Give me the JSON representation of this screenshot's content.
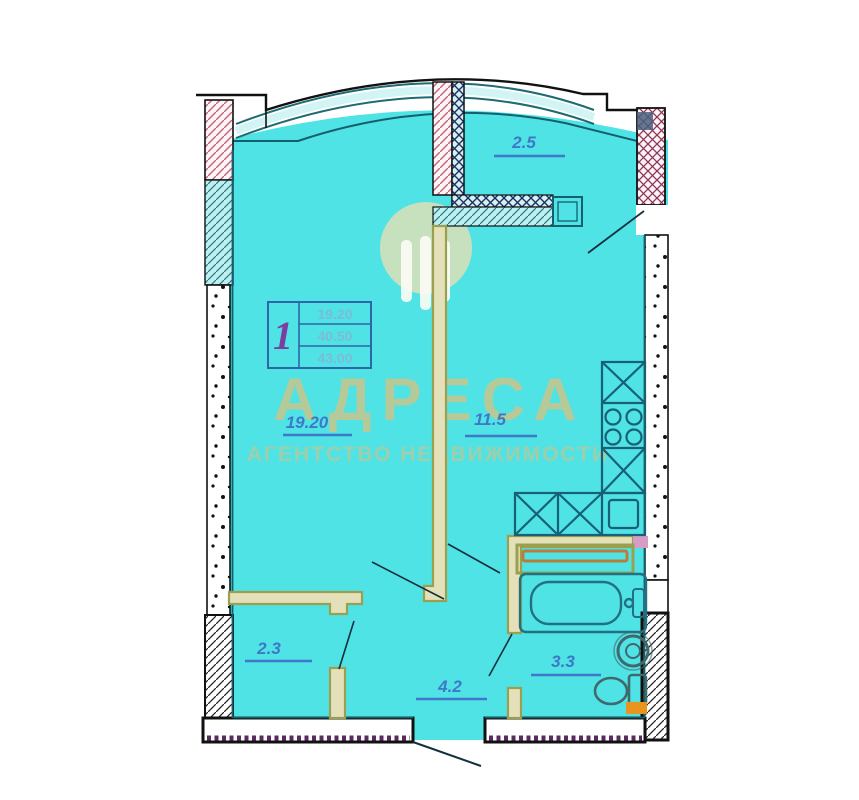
{
  "plan": {
    "info_box": {
      "rooms_count": "1",
      "living_area": "19.20",
      "total_area": "40.50",
      "total_with_balcony": "43.00"
    },
    "rooms": {
      "living": "19.20",
      "kitchen": "11.5",
      "balcony": "2.5",
      "closet": "2.3",
      "hall": "4.2",
      "bathroom": "3.3"
    }
  },
  "watermark": {
    "title": "АДРЕСА",
    "subtitle": "АГЕНТСТВО НЕДВИЖИМОСТИ"
  },
  "colors": {
    "floor": "#4fe3e6",
    "wall_line": "#135f6b",
    "partition_olive": "#9aa04f",
    "label_blue": "#3e78c8",
    "watermark_beige": "#cfc386",
    "accent_pink": "#d79cc6",
    "accent_orange": "#e8941f",
    "hatch_pink": "#c4657e",
    "teeth_purple": "#5c2a62"
  }
}
